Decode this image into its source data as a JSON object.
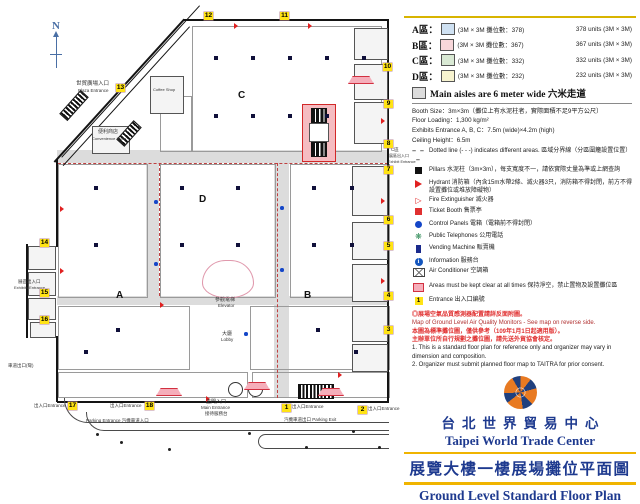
{
  "title": {
    "zh": "台北世界貿易中心",
    "en": "Taipei World Trade Center",
    "sub_zh": "展覽大樓一樓展場攤位平面圖",
    "sub_en": "Ground Level Standard Floor Plan"
  },
  "legend": {
    "areas": [
      {
        "name": "A區：",
        "zh": "(3M × 3M 攤位數：378)",
        "en": "378 units (3M × 3M)",
        "color": "#cfe1f2"
      },
      {
        "name": "B區：",
        "zh": "(3M × 3M 攤位數：367)",
        "en": "367 units (3M × 3M)",
        "color": "#f8d7da"
      },
      {
        "name": "C區：",
        "zh": "(3M × 3M 攤位數：332)",
        "en": "332 units (3M × 3M)",
        "color": "#d9e9d4"
      },
      {
        "name": "D區：",
        "zh": "(3M × 3M 攤位數：232)",
        "en": "232 units (3M × 3M)",
        "color": "#f7f3cf"
      }
    ],
    "aisle_note": "Main aisles are 6 meter wide 六米走道",
    "aisle_color": "#dcdcdc",
    "specs": [
      "Booth Size：3m×3m（攤位上有水泥柱者，實際面積不足9平方公尺）",
      "Floor Loading：1,300 kg/m²",
      "Exhibits Entrance A, B, C：7.5m (wide)×4.2m (high)",
      "Ceiling Height：6.5m"
    ],
    "items": [
      {
        "icon": "dotted-line-icon",
        "text": "Dotted line (- - -) indicates different areas. 區域分界線（分區圍籬設置位置）"
      },
      {
        "icon": "pillar-icon",
        "text": "Pillars 水泥柱（3m×3m），每支寬度不一，請依實際丈量為準或上網查詢"
      },
      {
        "icon": "hydrant-icon",
        "text": "Hydrant 消防箱（內含15m水帶2條、滅火器3只，消防箱不得封閉，前方不得設置攤位或堆放障礙物）"
      },
      {
        "icon": "fire-extinguisher-icon",
        "text": "Fire Extinguisher 滅火器"
      },
      {
        "icon": "ticket-booth-icon",
        "text": "Ticket Booth 售票亭"
      },
      {
        "icon": "control-panel-icon",
        "text": "Control Panels 電箱（電箱前不得封閉）"
      },
      {
        "icon": "telephone-icon",
        "text": "Public Telephones 公用電話"
      },
      {
        "icon": "vending-machine-icon",
        "text": "Vending Machine 販賣機"
      },
      {
        "icon": "information-icon",
        "text": "Information 服務台"
      },
      {
        "icon": "air-conditioner-icon",
        "text": "Air Conditioner 空調箱"
      },
      {
        "icon": "keep-clear-icon",
        "text": "Areas must be kept clear at all times 保持淨空，禁止置物及設置攤位區"
      },
      {
        "icon": "entrance-badge-icon",
        "text": "Entrance 出入口編號",
        "badge": "1"
      }
    ],
    "info_i": "i",
    "notes": [
      {
        "cls": "n-red",
        "text": "◎展場空氣品質感測器配置請詳反面附圖。"
      },
      {
        "cls": "n-darkred",
        "text": "Map of Ground Level Air Quality Monitors - See map on reverse side."
      },
      {
        "cls": "n-red",
        "text": "本圖為標準攤位圖，僅供參考（109年1月1日起適用版）。"
      },
      {
        "cls": "n-red",
        "text": "主辦單位所自行規劃之攤位圖，請先送外貿協會核定。"
      },
      {
        "cls": "n-black",
        "text": "1. This is a standard floor plan for reference only and organizer may vary in dimension and composition."
      },
      {
        "cls": "n-black",
        "text": "2. Organizer must submit planned floor map to TAITRA for prior consent."
      }
    ]
  },
  "floorplan": {
    "compass": "N",
    "aisles": [
      {
        "x": 57,
        "y": 150,
        "w": 331,
        "h": 13
      },
      {
        "x": 57,
        "y": 296,
        "w": 331,
        "h": 9
      },
      {
        "x": 146,
        "y": 150,
        "w": 13,
        "h": 146
      },
      {
        "x": 274,
        "y": 150,
        "w": 15,
        "h": 248
      }
    ],
    "blocks": [
      {
        "x": 192,
        "y": 26,
        "w": 188,
        "h": 124,
        "type": "strips",
        "color": "#d9e9d4",
        "area": "C"
      },
      {
        "x": 160,
        "y": 96,
        "w": 30,
        "h": 54,
        "type": "strips",
        "color": "#d9e9d4",
        "area": "C"
      },
      {
        "x": 160,
        "y": 164,
        "w": 114,
        "h": 132,
        "type": "rows",
        "color": "#f7f3cf",
        "area": "D"
      },
      {
        "x": 58,
        "y": 164,
        "w": 88,
        "h": 132,
        "type": "rows",
        "color": "#cfe1f2",
        "area": "A"
      },
      {
        "x": 58,
        "y": 306,
        "w": 130,
        "h": 62,
        "type": "rows",
        "color": "#cfe1f2",
        "area": "A"
      },
      {
        "x": 58,
        "y": 372,
        "w": 188,
        "h": 24,
        "type": "rows",
        "color": "#cfe1f2",
        "area": "A"
      },
      {
        "x": 290,
        "y": 164,
        "w": 98,
        "h": 132,
        "type": "rows",
        "color": "#f8d7da",
        "area": "B"
      },
      {
        "x": 250,
        "y": 306,
        "w": 138,
        "h": 62,
        "type": "rows",
        "color": "#f8d7da",
        "area": "B"
      },
      {
        "x": 252,
        "y": 372,
        "w": 136,
        "h": 24,
        "type": "rows",
        "color": "#f8d7da",
        "area": "B"
      }
    ],
    "dashes": [
      {
        "x": 58,
        "y": 163,
        "w": 330,
        "h": 0
      },
      {
        "x": 159,
        "y": 163,
        "w": 0,
        "h": 133
      },
      {
        "x": 277,
        "y": 163,
        "w": 0,
        "h": 235
      }
    ],
    "walls": [
      {
        "x": 184,
        "y": 19,
        "w": 205,
        "h": 2
      },
      {
        "x": 387,
        "y": 19,
        "w": 2,
        "h": 384
      },
      {
        "x": 57,
        "y": 401,
        "w": 332,
        "h": 2
      },
      {
        "x": 56,
        "y": 159,
        "w": 2,
        "h": 88
      },
      {
        "x": 26,
        "y": 244,
        "w": 2,
        "h": 94
      },
      {
        "x": 56,
        "y": 336,
        "w": 2,
        "h": 66
      }
    ],
    "dwalls": [
      {
        "x": 185,
        "y": 20,
        "len": 193,
        "rot": 132.3,
        "th": 2
      },
      {
        "x": 190,
        "y": 27,
        "len": 188,
        "rot": 132.3,
        "th": 1
      },
      {
        "x": 200,
        "y": 6,
        "len": 205,
        "rot": 132.3,
        "th": 1
      }
    ],
    "rooms": [
      [
        354,
        28,
        32,
        30
      ],
      [
        354,
        64,
        32,
        34
      ],
      [
        354,
        102,
        32,
        40
      ],
      [
        352,
        166,
        34,
        48
      ],
      [
        352,
        222,
        34,
        36
      ],
      [
        352,
        264,
        34,
        36
      ],
      [
        352,
        306,
        34,
        34
      ],
      [
        352,
        344,
        34,
        26
      ],
      [
        28,
        246,
        26,
        22
      ],
      [
        28,
        272,
        26,
        22
      ],
      [
        28,
        298,
        26,
        20
      ],
      [
        30,
        322,
        24,
        14
      ],
      [
        150,
        76,
        32,
        36
      ],
      [
        92,
        126,
        36,
        26
      ]
    ],
    "stairs": [
      {
        "x": 58,
        "y": 100,
        "w": 30,
        "h": 9,
        "rot": -48
      },
      {
        "x": 116,
        "y": 128,
        "w": 24,
        "h": 9,
        "rot": -48
      },
      {
        "x": 298,
        "y": 384,
        "w": 34,
        "h": 13,
        "rot": 0
      }
    ],
    "service_box": {
      "x": 302,
      "y": 104,
      "w": 32,
      "h": 56
    },
    "elevator": {
      "x": 202,
      "y": 260,
      "w": 50,
      "h": 36
    },
    "doors": [
      [
        228,
        382
      ],
      [
        248,
        382
      ]
    ],
    "roads": [
      {
        "x": 64,
        "y": 398,
        "w": 324,
        "h": 24,
        "bw": "0 0 1.5px 1.5px",
        "br": "0 0 0 24px"
      },
      {
        "x": 86,
        "y": 412,
        "w": 302,
        "h": 18,
        "bw": "0 0 1.5px 1.5px",
        "br": "0 0 0 18px"
      },
      {
        "x": 258,
        "y": 434,
        "w": 130,
        "h": 13,
        "bw": "1.5px 0 1.5px 1.5px",
        "br": "8px 0 0 8px"
      }
    ],
    "dots": [
      [
        248,
        432
      ],
      [
        305,
        446
      ],
      [
        352,
        430
      ],
      [
        378,
        446
      ],
      [
        120,
        441
      ],
      [
        168,
        448
      ],
      [
        96,
        433
      ]
    ],
    "badges": [
      {
        "n": "1",
        "x": 282,
        "y": 404
      },
      {
        "n": "2",
        "x": 358,
        "y": 406
      },
      {
        "n": "3",
        "x": 384,
        "y": 326
      },
      {
        "n": "4",
        "x": 384,
        "y": 292
      },
      {
        "n": "5",
        "x": 384,
        "y": 242
      },
      {
        "n": "6",
        "x": 384,
        "y": 216
      },
      {
        "n": "7",
        "x": 384,
        "y": 166
      },
      {
        "n": "8",
        "x": 384,
        "y": 140
      },
      {
        "n": "9",
        "x": 384,
        "y": 100
      },
      {
        "n": "10",
        "x": 383,
        "y": 63
      },
      {
        "n": "11",
        "x": 280,
        "y": 12
      },
      {
        "n": "12",
        "x": 204,
        "y": 12
      },
      {
        "n": "13",
        "x": 116,
        "y": 84
      },
      {
        "n": "14",
        "x": 40,
        "y": 239
      },
      {
        "n": "15",
        "x": 40,
        "y": 289
      },
      {
        "n": "16",
        "x": 40,
        "y": 316
      },
      {
        "n": "17",
        "x": 68,
        "y": 402
      },
      {
        "n": "18",
        "x": 145,
        "y": 402
      }
    ],
    "pillars": [
      [
        216,
        58
      ],
      [
        253,
        58
      ],
      [
        290,
        58
      ],
      [
        327,
        58
      ],
      [
        364,
        58
      ],
      [
        216,
        116
      ],
      [
        253,
        116
      ],
      [
        290,
        116
      ],
      [
        327,
        116
      ],
      [
        182,
        188
      ],
      [
        238,
        188
      ],
      [
        182,
        245
      ],
      [
        238,
        245
      ],
      [
        96,
        188
      ],
      [
        96,
        245
      ],
      [
        118,
        330
      ],
      [
        86,
        352
      ],
      [
        314,
        188
      ],
      [
        352,
        188
      ],
      [
        314,
        245
      ],
      [
        352,
        245
      ],
      [
        318,
        330
      ],
      [
        356,
        352
      ]
    ],
    "control_panels": [
      [
        154,
        200
      ],
      [
        154,
        262
      ],
      [
        280,
        206
      ],
      [
        280,
        268
      ],
      [
        244,
        332
      ],
      [
        336,
        388
      ]
    ],
    "hydrants": [
      [
        234,
        23
      ],
      [
        308,
        23
      ],
      [
        381,
        118
      ],
      [
        381,
        198
      ],
      [
        381,
        278
      ],
      [
        60,
        206
      ],
      [
        60,
        268
      ],
      [
        206,
        396
      ],
      [
        338,
        372
      ],
      [
        160,
        302
      ]
    ],
    "keep_clear": [
      [
        156,
        388
      ],
      [
        244,
        382
      ],
      [
        318,
        388
      ],
      [
        348,
        76
      ]
    ],
    "area_letters": [
      {
        "t": "A",
        "x": 116,
        "y": 290
      },
      {
        "t": "B",
        "x": 304,
        "y": 290
      },
      {
        "t": "C",
        "x": 238,
        "y": 90
      },
      {
        "t": "D",
        "x": 199,
        "y": 194
      }
    ],
    "labels": [
      {
        "t": "世貿廣場入口",
        "x": 76,
        "y": 82,
        "s": 5.5
      },
      {
        "t": "Plaza Entrance",
        "x": 78,
        "y": 89,
        "s": 4.5
      },
      {
        "t": "Coffee Shop",
        "x": 153,
        "y": 88,
        "s": 4
      },
      {
        "t": "便利商店",
        "x": 98,
        "y": 130,
        "s": 5
      },
      {
        "t": "Convenience Store",
        "x": 92,
        "y": 137,
        "s": 4
      },
      {
        "t": "參觀電梯",
        "x": 215,
        "y": 298,
        "s": 5
      },
      {
        "t": "Elevator",
        "x": 218,
        "y": 304,
        "s": 4.5
      },
      {
        "t": "大廳",
        "x": 222,
        "y": 332,
        "s": 5
      },
      {
        "t": "Lobby",
        "x": 221,
        "y": 338,
        "s": 4.5
      },
      {
        "t": "正門入口",
        "x": 206,
        "y": 400,
        "s": 5
      },
      {
        "t": "Main Entrance",
        "x": 201,
        "y": 406,
        "s": 4.5
      },
      {
        "t": "接待服務台",
        "x": 205,
        "y": 412,
        "s": 4.5
      },
      {
        "t": "出入口Entrance",
        "x": 34,
        "y": 404,
        "s": 4.5
      },
      {
        "t": "出入口Entrance",
        "x": 110,
        "y": 404,
        "s": 4.5
      },
      {
        "t": "出入口Entrance",
        "x": 292,
        "y": 405,
        "s": 4.5
      },
      {
        "t": "出入口Entrance",
        "x": 368,
        "y": 407,
        "s": 4.5
      },
      {
        "t": "Parking Entrance 汽機車道入口",
        "x": 86,
        "y": 419,
        "s": 4.5
      },
      {
        "t": "汽機車道出口 Parking Exit",
        "x": 284,
        "y": 418,
        "s": 4.5
      },
      {
        "t": "展區出入口",
        "x": 18,
        "y": 280,
        "s": 4.5
      },
      {
        "t": "Exhibits Entrance",
        "x": 14,
        "y": 286,
        "s": 4
      },
      {
        "t": "車道出口(彎)",
        "x": 8,
        "y": 364,
        "s": 4.5
      },
      {
        "t": "C區",
        "x": 391,
        "y": 148,
        "s": 4.5
      },
      {
        "t": "展區出入口",
        "x": 389,
        "y": 154,
        "s": 4
      },
      {
        "t": "Exhibit Entrance",
        "x": 388,
        "y": 160,
        "s": 3.8
      }
    ]
  }
}
